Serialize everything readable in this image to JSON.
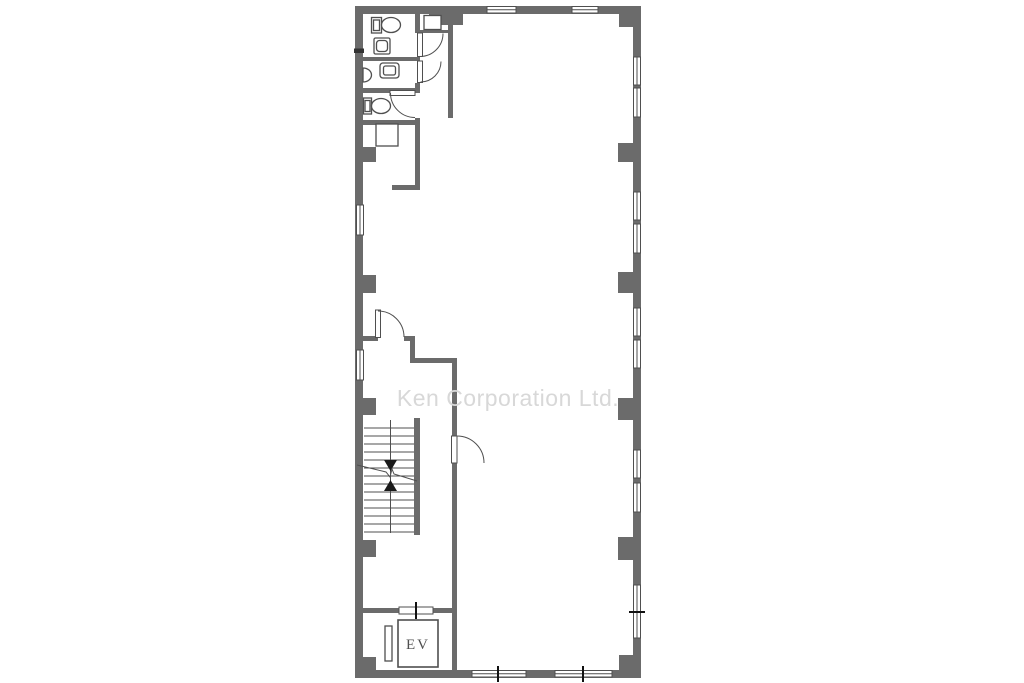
{
  "watermark": {
    "text": "Ken Corporation Ltd."
  },
  "elevator": {
    "label": "EV"
  },
  "colors": {
    "wall": "#6b6b6b",
    "line": "#4f4f4f",
    "tick": "#111111",
    "watermark": "#d8d8d8",
    "background": "#ffffff"
  }
}
